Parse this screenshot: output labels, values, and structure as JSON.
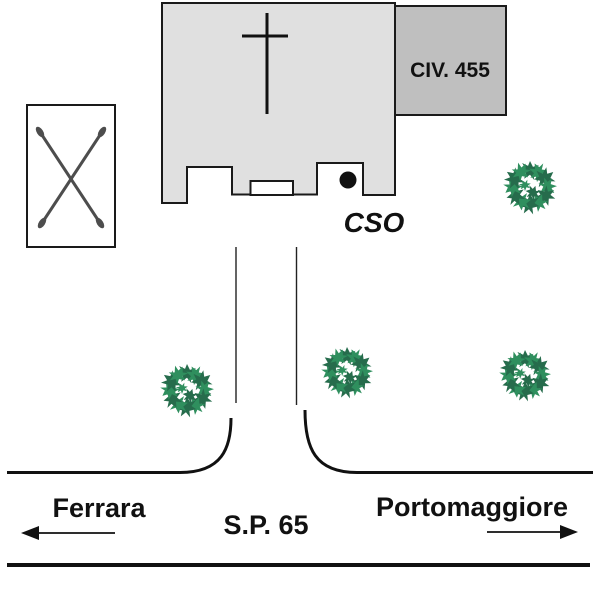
{
  "map": {
    "labels": {
      "civ": "CIV. 455",
      "cso": "CSO",
      "road_name": "S.P. 65",
      "destination_left": "Ferrara",
      "destination_right": "Portomaggiore"
    },
    "icons": {
      "church_cross": "cross-icon",
      "entrance_dot": "dot-marker-icon",
      "crossed_poles": "crossed-poles-icon",
      "tree": "tree-icon",
      "arrow_left": "arrow-left-icon",
      "arrow_right": "arrow-right-icon"
    },
    "colors": {
      "church_fill": "#e0e0e0",
      "annex_fill": "#bfbfbf",
      "outline": "#1a1a1a",
      "tree_green_dark": "#266c4c",
      "tree_green_light": "#2f8f5e",
      "x_marker": "#4d4d4d",
      "text_color": "#111111"
    },
    "trees": [
      {
        "x": 530,
        "y": 187,
        "r": 27
      },
      {
        "x": 187,
        "y": 390,
        "r": 27
      },
      {
        "x": 347,
        "y": 372,
        "r": 26
      },
      {
        "x": 525,
        "y": 375,
        "r": 26
      }
    ]
  }
}
